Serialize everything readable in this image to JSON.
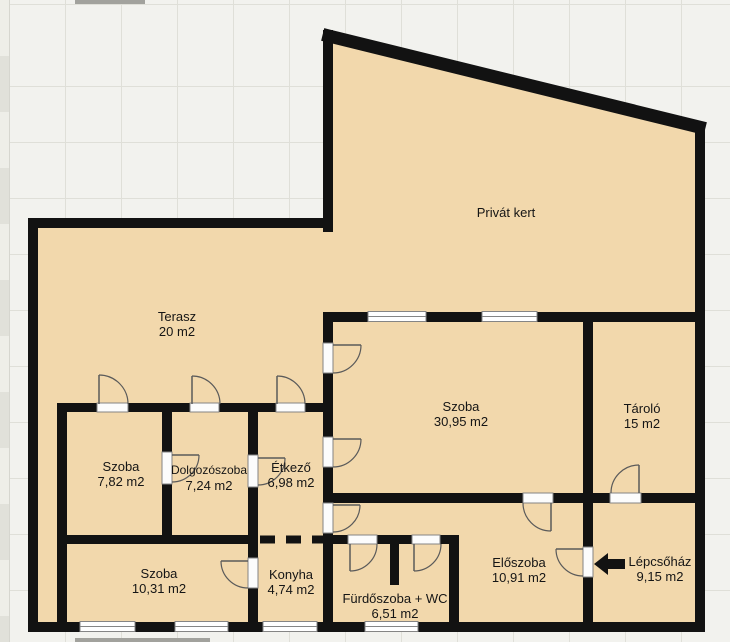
{
  "title": "Alaprajz",
  "colors": {
    "floor_fill": "#f2d8ac",
    "wall": "#121212",
    "grid_line": "#dfdfd8",
    "background": "#f2f2ee",
    "frame": "#858585",
    "arc": "#5a5a5a"
  },
  "icons": {
    "entrance_arrow": "left-arrow"
  },
  "rooms": [
    {
      "id": "privat-kert",
      "name": "Privát kert",
      "area": ""
    },
    {
      "id": "terasz",
      "name": "Terasz",
      "area": "20 m2"
    },
    {
      "id": "szoba-nagy",
      "name": "Szoba",
      "area": "30,95 m2"
    },
    {
      "id": "tarolo",
      "name": "Tároló",
      "area": "15 m2"
    },
    {
      "id": "szoba-bal",
      "name": "Szoba",
      "area": "7,82 m2"
    },
    {
      "id": "dolgozoszoba",
      "name": "Dolgozószoba",
      "area": "7,24 m2"
    },
    {
      "id": "etkezo",
      "name": "Étkező",
      "area": "6,98 m2"
    },
    {
      "id": "szoba-also",
      "name": "Szoba",
      "area": "10,31 m2"
    },
    {
      "id": "konyha",
      "name": "Konyha",
      "area": "4,74 m2"
    },
    {
      "id": "furdoszoba",
      "name": "Fürdőszoba + WC",
      "area": "6,51 m2"
    },
    {
      "id": "eloszoba",
      "name": "Előszoba",
      "area": "10,91 m2"
    },
    {
      "id": "lepcsohaz",
      "name": "Lépcsőház",
      "area": "9,15 m2"
    }
  ]
}
